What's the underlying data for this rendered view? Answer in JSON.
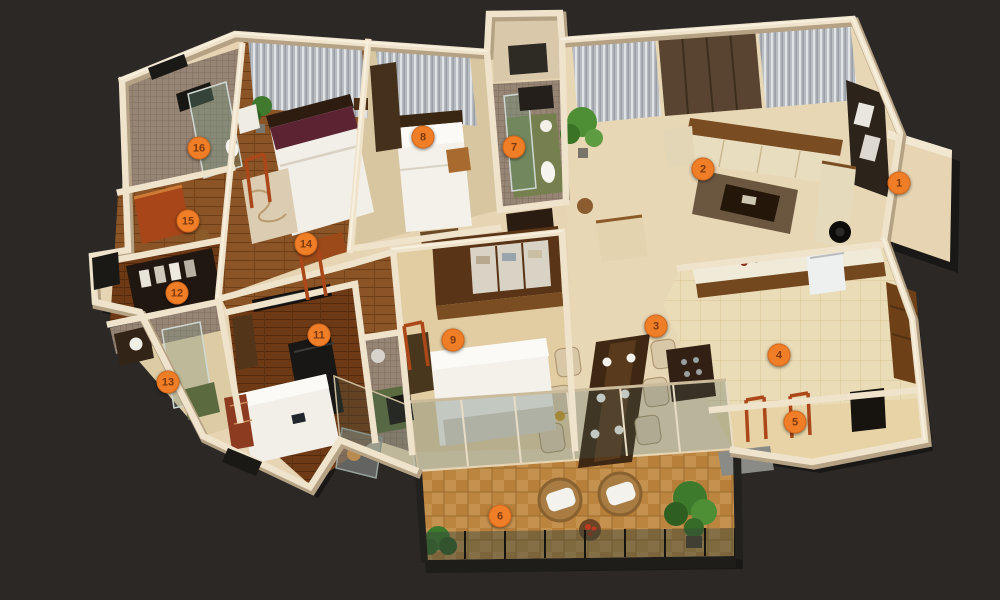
{
  "colors": {
    "background": "#2b2826",
    "wall": "#efe3cc",
    "wall_shadow": "#b5a183",
    "floor_base": "#e6d4b2",
    "floor_living": "#e8d7b5",
    "floor_wood": "#8a5426",
    "floor_wood_dark": "#6e3a16",
    "floor_parquet": "#c4914f",
    "floor_tile": "#eadcb6",
    "mosaic": "#968474",
    "curtain": "#b9bdc2",
    "glass": "#46605a",
    "accent_red": "#a84619",
    "furniture_dark": "#2a1c10",
    "white_furniture": "#f2efe8",
    "marker": "#ef7e27",
    "marker_text": "#7e3a0e"
  },
  "markers": [
    {
      "number": "1",
      "room": "entrance",
      "x": 899,
      "y": 183
    },
    {
      "number": "2",
      "room": "living-room",
      "x": 703,
      "y": 169
    },
    {
      "number": "3",
      "room": "dining-area",
      "x": 656,
      "y": 326
    },
    {
      "number": "4",
      "room": "kitchen",
      "x": 779,
      "y": 355
    },
    {
      "number": "5",
      "room": "utility",
      "x": 795,
      "y": 422
    },
    {
      "number": "6",
      "room": "balcony",
      "x": 500,
      "y": 516
    },
    {
      "number": "7",
      "room": "bathroom-2",
      "x": 514,
      "y": 147
    },
    {
      "number": "8",
      "room": "bedroom-2",
      "x": 423,
      "y": 137
    },
    {
      "number": "9",
      "room": "dressing-area",
      "x": 453,
      "y": 340
    },
    {
      "number": "11",
      "room": "bedroom-3",
      "x": 319,
      "y": 335
    },
    {
      "number": "12",
      "room": "wardrobe",
      "x": 177,
      "y": 293
    },
    {
      "number": "13",
      "room": "bathroom-3",
      "x": 168,
      "y": 382
    },
    {
      "number": "14",
      "room": "master-bedroom",
      "x": 306,
      "y": 244
    },
    {
      "number": "15",
      "room": "dressing-room",
      "x": 188,
      "y": 221
    },
    {
      "number": "16",
      "room": "master-bathroom",
      "x": 199,
      "y": 148
    }
  ]
}
